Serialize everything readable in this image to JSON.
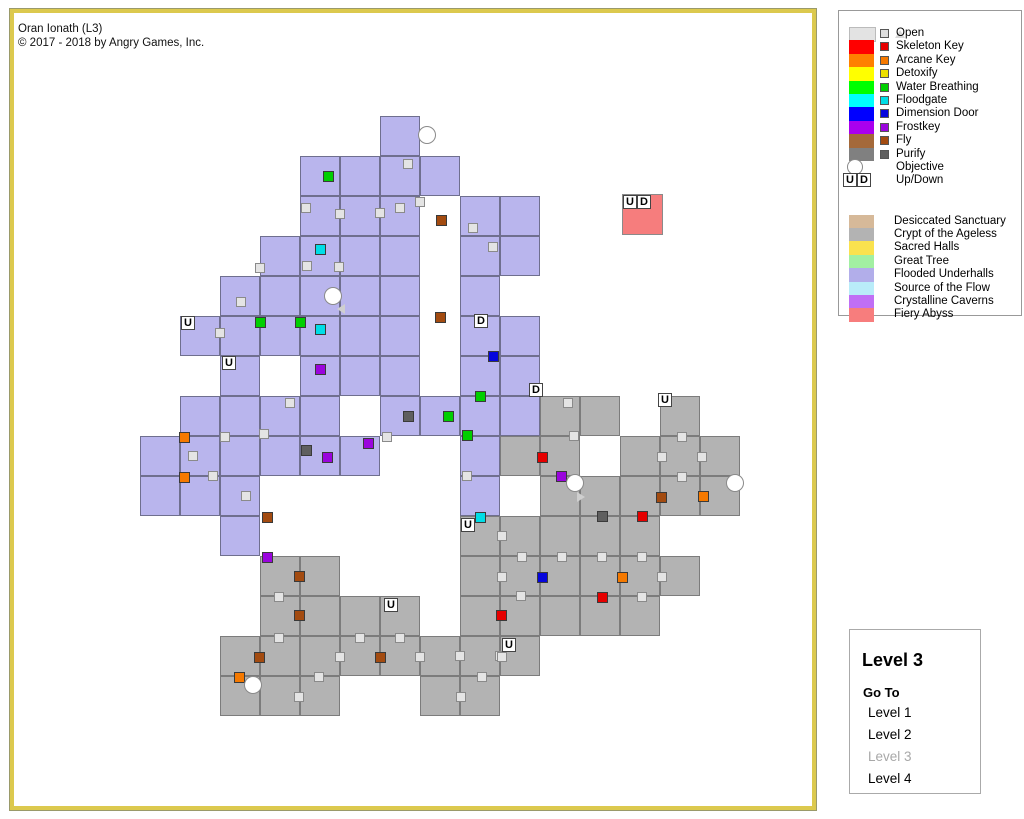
{
  "title": {
    "line1": "Oran Ionath (L3)",
    "line2": "© 2017 - 2018 by Angry Games, Inc."
  },
  "legend": {
    "doors": [
      {
        "label": "Open",
        "big": "#e3e3e3",
        "small": "#dedede",
        "glyph": "open"
      },
      {
        "label": "Skeleton Key",
        "big": "#ff0000",
        "small": "#e60000",
        "glyph": "square"
      },
      {
        "label": "Arcane Key",
        "big": "#ff8000",
        "small": "#f57900",
        "glyph": "square"
      },
      {
        "label": "Detoxify",
        "big": "#ffff00",
        "small": "#eee000",
        "glyph": "square"
      },
      {
        "label": "Water Breathing",
        "big": "#00ff00",
        "small": "#00cf00",
        "glyph": "square"
      },
      {
        "label": "Floodgate",
        "big": "#00ffff",
        "small": "#00dde6",
        "glyph": "square"
      },
      {
        "label": "Dimension Door",
        "big": "#0000ff",
        "small": "#0505dd",
        "glyph": "square"
      },
      {
        "label": "Frostkey",
        "big": "#aa00ee",
        "small": "#9a05dd",
        "glyph": "square"
      },
      {
        "label": "Fly",
        "big": "#a4693a",
        "small": "#a34b10",
        "glyph": "square"
      },
      {
        "label": "Purify",
        "big": "#808080",
        "small": "#5f5f5f",
        "glyph": "square"
      },
      {
        "label": "Objective",
        "big": "",
        "small": "",
        "glyph": "circle"
      },
      {
        "label": "Up/Down",
        "big": "",
        "small": "",
        "glyph": "updown",
        "u": "U",
        "d": "D"
      }
    ],
    "areas": [
      {
        "label": "Desiccated Sanctuary",
        "color": "#d6b999"
      },
      {
        "label": "Crypt of the Ageless",
        "color": "#b3b3b3"
      },
      {
        "label": "Sacred Halls",
        "color": "#fae24e"
      },
      {
        "label": "Great Tree",
        "color": "#a2f0a2"
      },
      {
        "label": "Flooded Underhalls",
        "color": "#b2aeea"
      },
      {
        "label": "Source of the Flow",
        "color": "#b9ecf9"
      },
      {
        "label": "Crystalline Caverns",
        "color": "#c06ff5"
      },
      {
        "label": "Fiery Abyss",
        "color": "#f77d7d"
      }
    ]
  },
  "level_panel": {
    "title": "Level 3",
    "goto": "Go To",
    "levels": [
      {
        "label": "Level 1",
        "enabled": true
      },
      {
        "label": "Level 2",
        "enabled": true
      },
      {
        "label": "Level 3",
        "enabled": false
      },
      {
        "label": "Level 4",
        "enabled": true
      }
    ]
  },
  "map": {
    "origin": {
      "x": 140,
      "y": 116
    },
    "cell_size": 40,
    "region_colors": {
      "flooded": {
        "fill": "#b9b5ed",
        "border": "#6f6f8e"
      },
      "crypt": {
        "fill": "#b3b3b3",
        "border": "#7c7c7c"
      },
      "fiery": {
        "fill": "#f67d7d",
        "border": "#8a8a8a"
      }
    },
    "door_colors": {
      "open": "#e4e4e4",
      "skeleton": "#e60000",
      "arcane": "#f57900",
      "water": "#00cf00",
      "floodgate": "#00dde6",
      "dimension": "#0505dd",
      "frostkey": "#9a05dd",
      "fly": "#a34b10",
      "purify": "#5f5f5f"
    },
    "cells": {
      "flooded": [
        [
          6,
          0
        ],
        [
          4,
          1
        ],
        [
          5,
          1
        ],
        [
          6,
          1
        ],
        [
          7,
          1
        ],
        [
          4,
          2
        ],
        [
          5,
          2
        ],
        [
          6,
          2
        ],
        [
          8,
          2
        ],
        [
          9,
          2
        ],
        [
          3,
          3
        ],
        [
          4,
          3
        ],
        [
          5,
          3
        ],
        [
          6,
          3
        ],
        [
          8,
          3
        ],
        [
          9,
          3
        ],
        [
          2,
          4
        ],
        [
          3,
          4
        ],
        [
          4,
          4
        ],
        [
          5,
          4
        ],
        [
          6,
          4
        ],
        [
          8,
          4
        ],
        [
          1,
          5
        ],
        [
          2,
          5
        ],
        [
          3,
          5
        ],
        [
          4,
          5
        ],
        [
          5,
          5
        ],
        [
          6,
          5
        ],
        [
          8,
          5
        ],
        [
          9,
          5
        ],
        [
          2,
          6
        ],
        [
          4,
          6
        ],
        [
          5,
          6
        ],
        [
          6,
          6
        ],
        [
          8,
          6
        ],
        [
          9,
          6
        ],
        [
          1,
          7
        ],
        [
          2,
          7
        ],
        [
          3,
          7
        ],
        [
          4,
          7
        ],
        [
          6,
          7
        ],
        [
          7,
          7
        ],
        [
          8,
          7
        ],
        [
          9,
          7
        ],
        [
          0,
          8
        ],
        [
          1,
          8
        ],
        [
          2,
          8
        ],
        [
          3,
          8
        ],
        [
          4,
          8
        ],
        [
          5,
          8
        ],
        [
          8,
          8
        ],
        [
          0,
          9
        ],
        [
          1,
          9
        ],
        [
          2,
          9
        ],
        [
          8,
          9
        ],
        [
          2,
          10
        ]
      ],
      "crypt": [
        [
          10,
          7
        ],
        [
          11,
          7
        ],
        [
          13,
          7
        ],
        [
          9,
          8
        ],
        [
          10,
          8
        ],
        [
          12,
          8
        ],
        [
          13,
          8
        ],
        [
          14,
          8
        ],
        [
          10,
          9
        ],
        [
          11,
          9
        ],
        [
          12,
          9
        ],
        [
          13,
          9
        ],
        [
          14,
          9
        ],
        [
          8,
          10
        ],
        [
          9,
          10
        ],
        [
          10,
          10
        ],
        [
          11,
          10
        ],
        [
          12,
          10
        ],
        [
          3,
          11
        ],
        [
          4,
          11
        ],
        [
          8,
          11
        ],
        [
          9,
          11
        ],
        [
          10,
          11
        ],
        [
          11,
          11
        ],
        [
          12,
          11
        ],
        [
          13,
          11
        ],
        [
          3,
          12
        ],
        [
          4,
          12
        ],
        [
          5,
          12
        ],
        [
          6,
          12
        ],
        [
          8,
          12
        ],
        [
          9,
          12
        ],
        [
          10,
          12
        ],
        [
          11,
          12
        ],
        [
          12,
          12
        ],
        [
          2,
          13
        ],
        [
          3,
          13
        ],
        [
          4,
          13
        ],
        [
          5,
          13
        ],
        [
          6,
          13
        ],
        [
          7,
          13
        ],
        [
          8,
          13
        ],
        [
          9,
          13
        ],
        [
          2,
          14
        ],
        [
          3,
          14
        ],
        [
          4,
          14
        ],
        [
          7,
          14
        ],
        [
          8,
          14
        ]
      ]
    },
    "extra_rooms": [
      {
        "x": 622,
        "y": 194,
        "w": 41,
        "h": 41,
        "region": "fiery"
      }
    ],
    "doors": [
      {
        "x": 408,
        "y": 164,
        "t": "open"
      },
      {
        "x": 306,
        "y": 208,
        "t": "open"
      },
      {
        "x": 340,
        "y": 214,
        "t": "open"
      },
      {
        "x": 380,
        "y": 213,
        "t": "open"
      },
      {
        "x": 400,
        "y": 208,
        "t": "open"
      },
      {
        "x": 420,
        "y": 202,
        "t": "open"
      },
      {
        "x": 473,
        "y": 228,
        "t": "open"
      },
      {
        "x": 493,
        "y": 247,
        "t": "open"
      },
      {
        "x": 260,
        "y": 268,
        "t": "open"
      },
      {
        "x": 307,
        "y": 266,
        "t": "open"
      },
      {
        "x": 339,
        "y": 267,
        "t": "open"
      },
      {
        "x": 241,
        "y": 302,
        "t": "open"
      },
      {
        "x": 220,
        "y": 333,
        "t": "open"
      },
      {
        "x": 290,
        "y": 403,
        "t": "open"
      },
      {
        "x": 193,
        "y": 456,
        "t": "open"
      },
      {
        "x": 225,
        "y": 437,
        "t": "open"
      },
      {
        "x": 213,
        "y": 476,
        "t": "open"
      },
      {
        "x": 246,
        "y": 496,
        "t": "open"
      },
      {
        "x": 264,
        "y": 434,
        "t": "open"
      },
      {
        "x": 387,
        "y": 437,
        "t": "open"
      },
      {
        "x": 467,
        "y": 476,
        "t": "open"
      },
      {
        "x": 568,
        "y": 403,
        "t": "open"
      },
      {
        "x": 574,
        "y": 436,
        "t": "open"
      },
      {
        "x": 682,
        "y": 437,
        "t": "open"
      },
      {
        "x": 662,
        "y": 457,
        "t": "open"
      },
      {
        "x": 702,
        "y": 457,
        "t": "open"
      },
      {
        "x": 682,
        "y": 477,
        "t": "open"
      },
      {
        "x": 502,
        "y": 536,
        "t": "open"
      },
      {
        "x": 522,
        "y": 557,
        "t": "open"
      },
      {
        "x": 562,
        "y": 557,
        "t": "open"
      },
      {
        "x": 602,
        "y": 557,
        "t": "open"
      },
      {
        "x": 642,
        "y": 557,
        "t": "open"
      },
      {
        "x": 502,
        "y": 577,
        "t": "open"
      },
      {
        "x": 662,
        "y": 577,
        "t": "open"
      },
      {
        "x": 521,
        "y": 596,
        "t": "open"
      },
      {
        "x": 642,
        "y": 597,
        "t": "open"
      },
      {
        "x": 279,
        "y": 597,
        "t": "open"
      },
      {
        "x": 279,
        "y": 638,
        "t": "open"
      },
      {
        "x": 360,
        "y": 638,
        "t": "open"
      },
      {
        "x": 400,
        "y": 638,
        "t": "open"
      },
      {
        "x": 340,
        "y": 657,
        "t": "open"
      },
      {
        "x": 420,
        "y": 657,
        "t": "open"
      },
      {
        "x": 460,
        "y": 656,
        "t": "open"
      },
      {
        "x": 500,
        "y": 656,
        "t": "open"
      },
      {
        "x": 502,
        "y": 657,
        "t": "open"
      },
      {
        "x": 319,
        "y": 677,
        "t": "open"
      },
      {
        "x": 482,
        "y": 677,
        "t": "open"
      },
      {
        "x": 299,
        "y": 697,
        "t": "open"
      },
      {
        "x": 461,
        "y": 697,
        "t": "open"
      },
      {
        "x": 542,
        "y": 457,
        "t": "skeleton"
      },
      {
        "x": 642,
        "y": 516,
        "t": "skeleton"
      },
      {
        "x": 602,
        "y": 597,
        "t": "skeleton"
      },
      {
        "x": 501,
        "y": 615,
        "t": "skeleton"
      },
      {
        "x": 184,
        "y": 437,
        "t": "arcane"
      },
      {
        "x": 184,
        "y": 477,
        "t": "arcane"
      },
      {
        "x": 703,
        "y": 496,
        "t": "arcane"
      },
      {
        "x": 622,
        "y": 577,
        "t": "arcane"
      },
      {
        "x": 239,
        "y": 677,
        "t": "arcane"
      },
      {
        "x": 328,
        "y": 176,
        "t": "water"
      },
      {
        "x": 260,
        "y": 322,
        "t": "water"
      },
      {
        "x": 300,
        "y": 322,
        "t": "water"
      },
      {
        "x": 448,
        "y": 416,
        "t": "water"
      },
      {
        "x": 467,
        "y": 435,
        "t": "water"
      },
      {
        "x": 480,
        "y": 396,
        "t": "water"
      },
      {
        "x": 320,
        "y": 249,
        "t": "floodgate"
      },
      {
        "x": 320,
        "y": 329,
        "t": "floodgate"
      },
      {
        "x": 480,
        "y": 517,
        "t": "floodgate"
      },
      {
        "x": 493,
        "y": 356,
        "t": "dimension"
      },
      {
        "x": 542,
        "y": 577,
        "t": "dimension"
      },
      {
        "x": 320,
        "y": 369,
        "t": "frostkey"
      },
      {
        "x": 368,
        "y": 443,
        "t": "frostkey"
      },
      {
        "x": 327,
        "y": 457,
        "t": "frostkey"
      },
      {
        "x": 561,
        "y": 476,
        "t": "frostkey"
      },
      {
        "x": 267,
        "y": 557,
        "t": "frostkey"
      },
      {
        "x": 441,
        "y": 220,
        "t": "fly"
      },
      {
        "x": 440,
        "y": 317,
        "t": "fly"
      },
      {
        "x": 267,
        "y": 517,
        "t": "fly"
      },
      {
        "x": 299,
        "y": 576,
        "t": "fly"
      },
      {
        "x": 299,
        "y": 615,
        "t": "fly"
      },
      {
        "x": 661,
        "y": 497,
        "t": "fly"
      },
      {
        "x": 259,
        "y": 657,
        "t": "fly"
      },
      {
        "x": 380,
        "y": 657,
        "t": "fly"
      },
      {
        "x": 306,
        "y": 450,
        "t": "purify"
      },
      {
        "x": 408,
        "y": 416,
        "t": "purify"
      },
      {
        "x": 602,
        "y": 516,
        "t": "purify"
      }
    ],
    "labels": [
      {
        "x": 181,
        "y": 316,
        "text": "U"
      },
      {
        "x": 222,
        "y": 356,
        "text": "U"
      },
      {
        "x": 461,
        "y": 518,
        "text": "U"
      },
      {
        "x": 658,
        "y": 393,
        "text": "U"
      },
      {
        "x": 384,
        "y": 598,
        "text": "U"
      },
      {
        "x": 502,
        "y": 638,
        "text": "U"
      },
      {
        "x": 474,
        "y": 314,
        "text": "D"
      },
      {
        "x": 529,
        "y": 383,
        "text": "D"
      },
      {
        "x": 623,
        "y": 195,
        "text": "U"
      },
      {
        "x": 637,
        "y": 195,
        "text": "D"
      }
    ],
    "objectives": [
      [
        427,
        135
      ],
      [
        333,
        296
      ],
      [
        575,
        483
      ],
      [
        735,
        483
      ],
      [
        253,
        685
      ]
    ],
    "triangles": [
      {
        "x": 341,
        "y": 309,
        "dir": "left"
      },
      {
        "x": 581,
        "y": 497,
        "dir": "right"
      }
    ]
  }
}
